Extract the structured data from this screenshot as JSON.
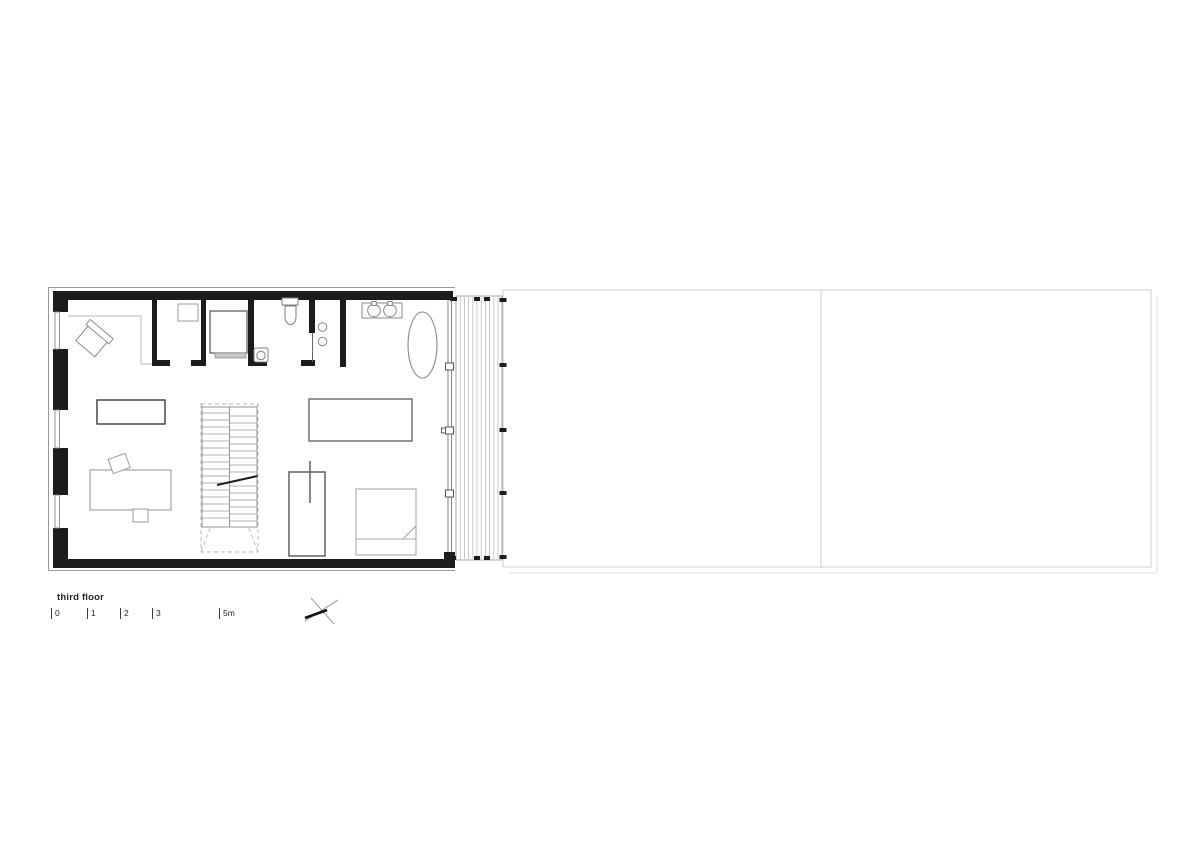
{
  "drawing": {
    "title": "third floor",
    "type": "architectural-floor-plan",
    "scale_bar": {
      "marks": [
        {
          "label": "0"
        },
        {
          "label": "1"
        },
        {
          "label": "2"
        },
        {
          "label": "3"
        },
        {
          "label": "5m"
        }
      ]
    },
    "symbols": {
      "north_mark": "crossed-lines-marker",
      "stair_direction": "dashed-x-lines",
      "deck": "vertical-board-hatching"
    },
    "colors": {
      "wall_poche": "#1c1c1c",
      "fixture_line": "#7d7d7d",
      "furniture_line": "#999999",
      "site_outline": "#cccccc",
      "deck_board": "#bdbdbd",
      "text": "#222222",
      "background": "#ffffff"
    }
  }
}
